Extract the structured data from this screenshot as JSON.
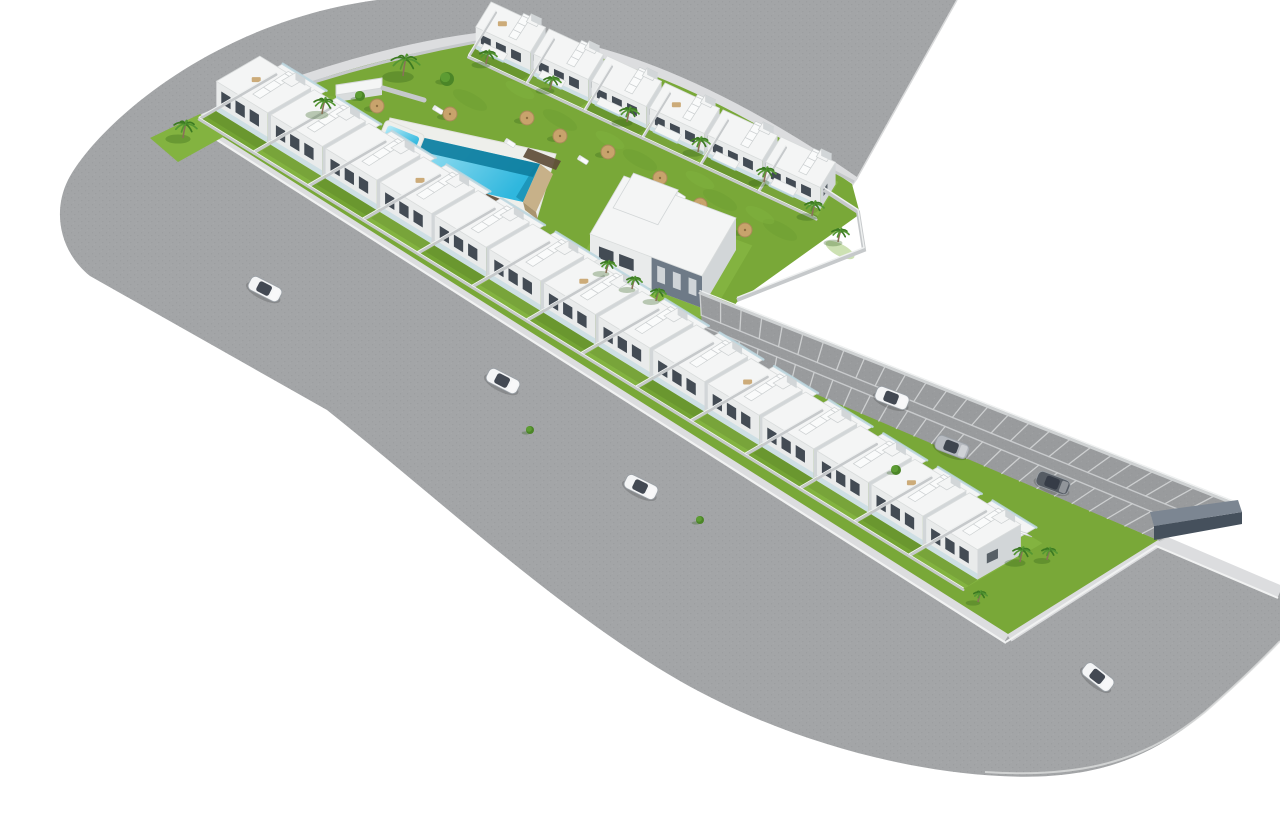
{
  "meta": {
    "description": "3D aerial architectural render of a white residential development with communal pool, gardens, perimeter road and parking lane",
    "width": 1280,
    "height": 820
  },
  "palette": {
    "background": "#ffffff",
    "road": "#a3a5a7",
    "roadSpeck": "#8e9092",
    "parkingAsphalt": "#999b9d",
    "sidewalk": "#dcdddf",
    "curb": "#f1f2f2",
    "grassBase": "#79a838",
    "grassBright": "#83b340",
    "grassAlt": "#74a434",
    "grassShade": "#64952c",
    "houseWhite": "#f4f5f5",
    "houseFace": "#e9ebeb",
    "houseShade": "#d2d6d8",
    "houseDark": "#6e7a87",
    "windowDark": "#434b54",
    "glass": "#bcd7e0",
    "wallLight": "#c6c9cb",
    "wallTop": "#eef0f0",
    "wallDark": "#45505c",
    "wood": "#5f4d38",
    "poolDeck": "#eeefeb",
    "poolShallow": "#b9ecf8",
    "poolDeep": "#2fb7de",
    "poolShadow": "#0e7d9e",
    "poolStone": "#c7b189",
    "palmFrond": "#3c7a22",
    "palmFrondLight": "#549633",
    "palmTrunk": "#8a7158",
    "treeGreen": "#4b8527",
    "treeLight": "#5d9c33",
    "parasol": "#c8a36c",
    "parasolEdge": "#a98a58",
    "carWhite": "#f4f5f6",
    "carSilver": "#b6bac0",
    "carDark": "#565c64",
    "carGlass": "#333a44",
    "shadow": "rgba(40,60,20,0.12)"
  },
  "scene": {
    "roadPath": "M 957,0 L 856,180 L 852,184 C 700,78 590,44 500,38 C 410,46 300,78 202,122 L 1008,636 L 1158,540 L 1280,592 L 1280,641 C 1263,659 1243,679 1205,712 C 1150,760 1090,781 1000,776 C 900,771 780,738 680,681 C 560,612 440,500 327,410 L 90,276 C 60,252 52,212 68,180 C 95,128 210,22 377,0 Z",
    "roadCutEdge": "M 957,0 L 856,180",
    "outerCurb": "M 985,772 C 1090,779 1150,757 1205,712 C 1243,679 1263,659 1280,641",
    "sidewalkMain": "M 854,184 C 700,78 590,44 500,38 C 410,46 300,78 202,122 L 1008,636",
    "sidewalkEast": "M 1008,636 L 1158,540 L 1280,592",
    "baseGreen": "M 202,124 C 300,80 410,48 500,40 C 590,46 700,80 852,184 L 860,214 L 737,302 L 705,346 L 1158,540 L 1008,634 Z",
    "cornerPatch": [
      [
        150,
        138
      ],
      [
        200,
        114
      ],
      [
        232,
        132
      ],
      [
        178,
        162
      ]
    ],
    "topFence": "M 204,122 Q 350,62 500,38 Q 660,78 854,182",
    "transitionWall": "M 824,190 L 858,212 L 864,250 L 737,300",
    "rows": [
      {
        "name": "upper-row",
        "origin": [
          468,
          58
        ],
        "u": [
          58,
          27
        ],
        "v": [
          22,
          -36
        ],
        "h": 22,
        "count": 6,
        "terrace": false,
        "balcony": true
      },
      {
        "name": "front-row",
        "origin": [
          198,
          120
        ],
        "u": [
          54.6,
          33.6
        ],
        "v": [
          62,
          -36
        ],
        "h": 30,
        "count": 14,
        "terrace": true,
        "balcony": false
      }
    ],
    "pool": {
      "deck": [
        [
          390,
          118
        ],
        [
          556,
          154
        ],
        [
          537,
          218
        ],
        [
          371,
          182
        ]
      ],
      "water": [
        [
          407,
          134
        ],
        [
          540,
          164
        ],
        [
          523,
          202
        ],
        [
          390,
          172
        ]
      ],
      "shadowTop": [
        [
          407,
          134
        ],
        [
          540,
          164
        ],
        [
          533,
          177
        ],
        [
          401,
          147
        ]
      ],
      "shadowRight": [
        [
          540,
          164
        ],
        [
          523,
          202
        ],
        [
          516,
          197
        ],
        [
          533,
          169
        ]
      ],
      "stone": [
        [
          540,
          164
        ],
        [
          523,
          202
        ],
        [
          536,
          212
        ],
        [
          553,
          174
        ]
      ],
      "stoneSide": [
        [
          523,
          202
        ],
        [
          536,
          212
        ],
        [
          538,
          220
        ],
        [
          525,
          210
        ]
      ],
      "kids": {
        "cx": 401,
        "cy": 139,
        "w": 34,
        "h": 17,
        "rot": 22
      }
    },
    "walkways": [
      [
        [
          333,
          146
        ],
        [
          369,
          160
        ],
        [
          362,
          172
        ],
        [
          326,
          158
        ]
      ],
      [
        [
          459,
          183
        ],
        [
          503,
          200
        ],
        [
          495,
          214
        ],
        [
          451,
          197
        ]
      ],
      [
        [
          528,
          148
        ],
        [
          561,
          161
        ],
        [
          556,
          170
        ],
        [
          523,
          157
        ]
      ]
    ],
    "pavilion": {
      "top": [
        [
          336,
          85
        ],
        [
          382,
          78
        ],
        [
          382,
          88
        ],
        [
          336,
          95
        ]
      ],
      "side": [
        [
          336,
          95
        ],
        [
          382,
          88
        ],
        [
          382,
          95
        ],
        [
          336,
          102
        ]
      ]
    },
    "gardenWall": [
      [
        383,
        88
      ],
      [
        424,
        100
      ]
    ],
    "centralBuilding": {
      "origin": [
        590,
        266
      ],
      "u": [
        112,
        42
      ],
      "v": [
        34,
        -58
      ],
      "h": 32,
      "darkFrom": 0.55
    },
    "parking": {
      "ne": [
        [
          700,
          293
        ],
        [
          1235,
          504
        ]
      ],
      "sw": [
        [
          703,
          346
        ],
        [
          1160,
          541
        ]
      ],
      "stalls": 26,
      "laneA": 0.42,
      "laneB": 0.62,
      "endWall": [
        [
          1150,
          512
        ],
        [
          1238,
          500
        ],
        [
          1242,
          512
        ],
        [
          1154,
          526
        ]
      ],
      "endWallFace": [
        [
          1154,
          526
        ],
        [
          1242,
          512
        ],
        [
          1242,
          524
        ],
        [
          1154,
          540
        ]
      ]
    },
    "mottleDark": [
      [
        300,
        120
      ],
      [
        360,
        150
      ],
      [
        470,
        100
      ],
      [
        560,
        120
      ],
      [
        640,
        160
      ],
      [
        720,
        200
      ],
      [
        780,
        230
      ],
      [
        500,
        200
      ],
      [
        430,
        150
      ],
      [
        690,
        260
      ],
      [
        900,
        520
      ],
      [
        960,
        560
      ]
    ],
    "mottleLight": [
      [
        340,
        105
      ],
      [
        520,
        90
      ],
      [
        610,
        140
      ],
      [
        700,
        180
      ],
      [
        760,
        215
      ],
      [
        840,
        250
      ],
      [
        930,
        545
      ]
    ],
    "palms": [
      [
        183,
        136,
        12
      ],
      [
        322,
        112,
        11
      ],
      [
        403,
        74,
        15
      ],
      [
        486,
        62,
        9
      ],
      [
        550,
        88,
        9
      ],
      [
        627,
        120,
        10
      ],
      [
        698,
        150,
        10
      ],
      [
        764,
        180,
        10
      ],
      [
        812,
        214,
        10
      ],
      [
        838,
        240,
        9
      ],
      [
        606,
        271,
        8
      ],
      [
        632,
        287,
        8
      ],
      [
        656,
        299,
        8
      ],
      [
        1020,
        560,
        10
      ],
      [
        1047,
        558,
        8
      ],
      [
        978,
        600,
        7
      ]
    ],
    "trees": [
      [
        447,
        79,
        7
      ],
      [
        360,
        96,
        5
      ],
      [
        896,
        470,
        5
      ],
      [
        530,
        430,
        4
      ],
      [
        700,
        520,
        4
      ]
    ],
    "parasols": [
      [
        331,
        127
      ],
      [
        377,
        106
      ],
      [
        450,
        114
      ],
      [
        527,
        118
      ],
      [
        560,
        136
      ],
      [
        608,
        152
      ],
      [
        660,
        178
      ],
      [
        700,
        205
      ],
      [
        745,
        230
      ]
    ],
    "loungers": [
      [
        352,
        117
      ],
      [
        438,
        110
      ],
      [
        510,
        143
      ],
      [
        583,
        160
      ],
      [
        680,
        196
      ],
      [
        362,
        150
      ]
    ],
    "cars": [
      {
        "x": 265,
        "y": 289,
        "a": 27,
        "c": "white"
      },
      {
        "x": 503,
        "y": 381,
        "a": 27,
        "c": "white"
      },
      {
        "x": 641,
        "y": 487,
        "a": 26,
        "c": "white"
      },
      {
        "x": 892,
        "y": 398,
        "a": 21,
        "c": "white"
      },
      {
        "x": 952,
        "y": 447,
        "a": 21,
        "c": "silver"
      },
      {
        "x": 1053,
        "y": 483,
        "a": 21,
        "c": "dark"
      },
      {
        "x": 1098,
        "y": 677,
        "a": 38,
        "c": "white"
      }
    ]
  }
}
